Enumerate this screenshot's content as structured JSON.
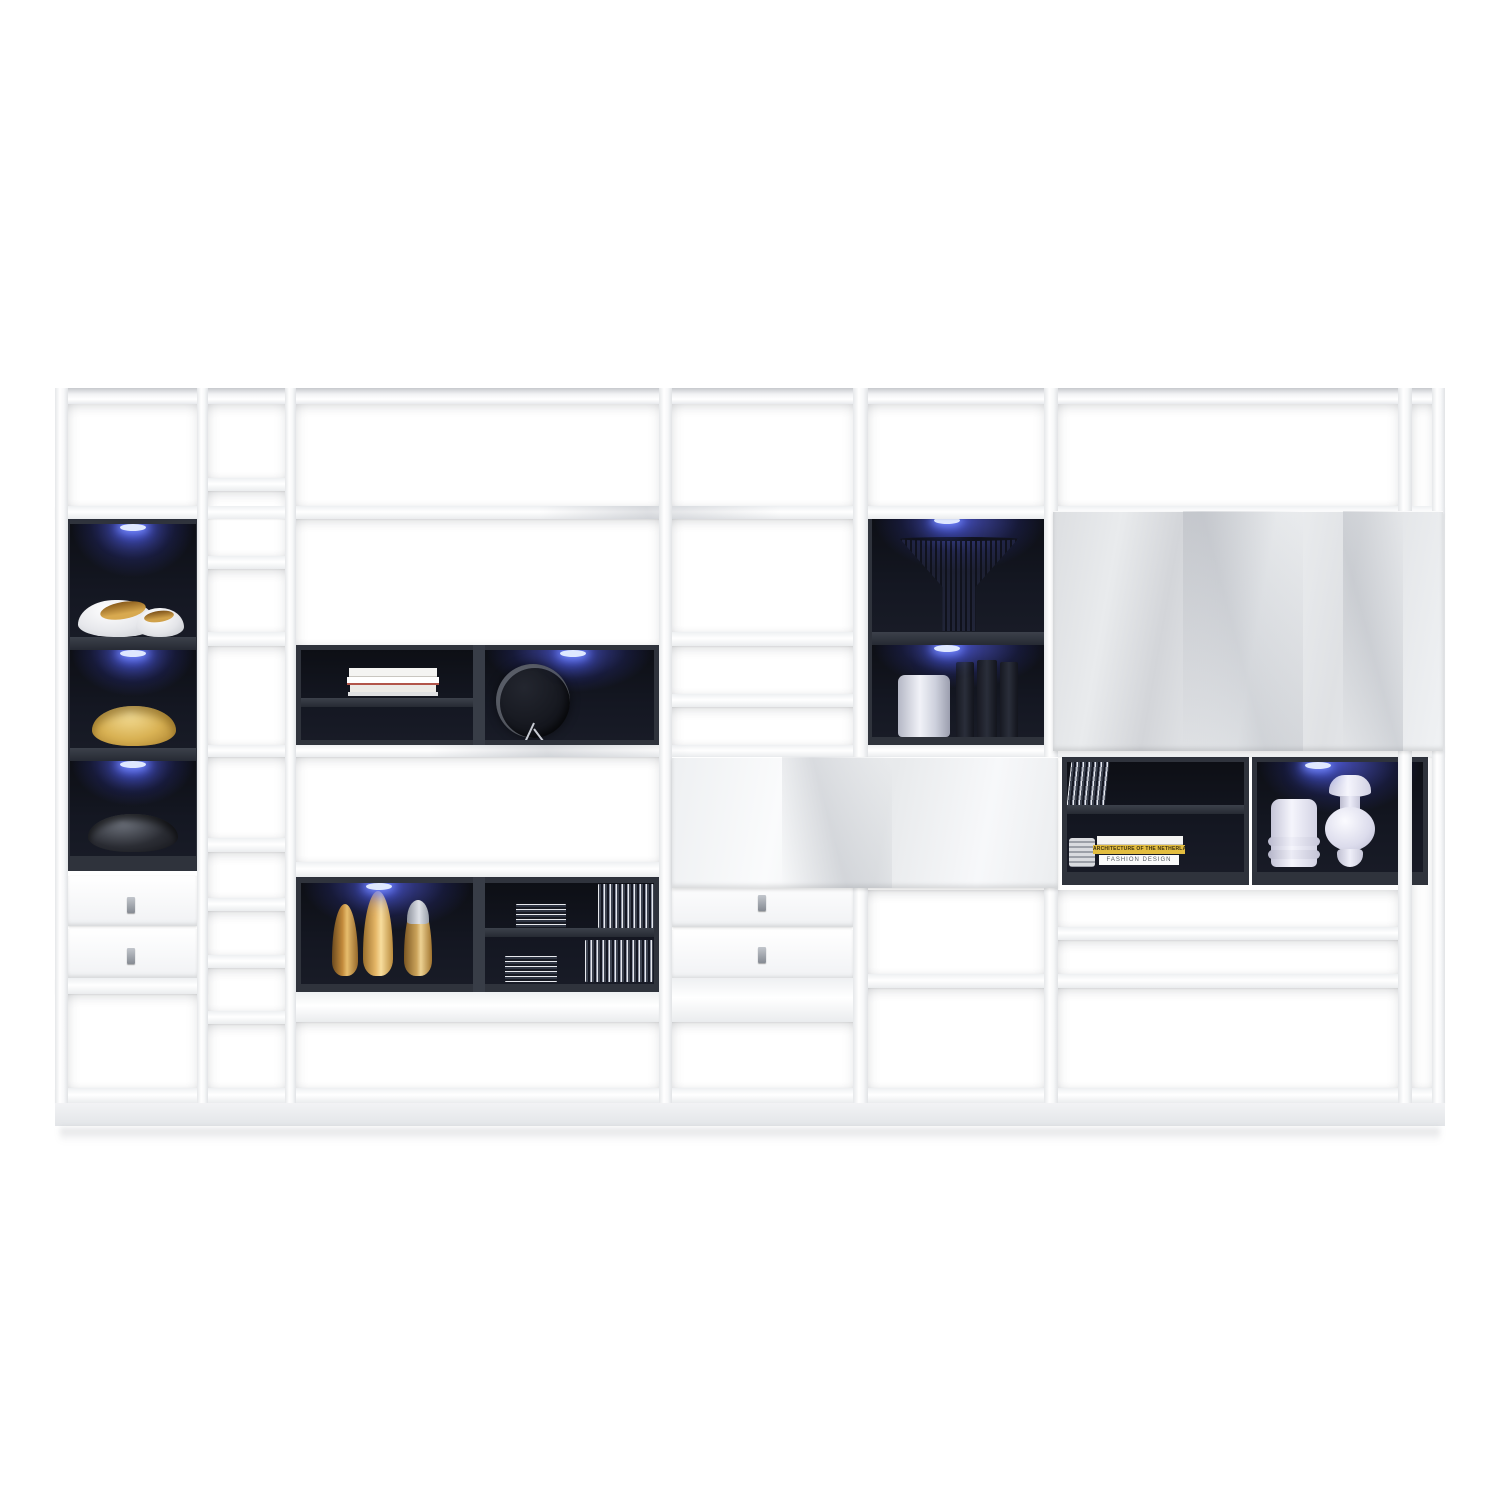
{
  "scene": {
    "type": "furniture product photo",
    "subject": "modular white high-gloss living-room wall shelving unit",
    "lighting": "blue LED spotlights inside dark display compartments",
    "background": "plain white studio background"
  },
  "palette": {
    "background": "#ffffff",
    "frame_white": "#f4f5f7",
    "frame_shadow": "#dadce0",
    "compartment_dark": "#12141c",
    "compartment_frame": "#2f333c",
    "led_blue": "#5a6cf0",
    "glass_panel_gray": "#e3e5e8",
    "gold": "#d9a85a",
    "silver": "#c9ccd4",
    "book_yellow": "#e3bd3f"
  },
  "texts": {
    "book_spine_yellow": "ARCHITECTURE OF THE NETHERLANDS",
    "book_spine_white": "FASHION DESIGN"
  },
  "objects": {
    "bowl_duo": "two white decorative shell bowls with gold interiors",
    "gold_bowl": "gold wavy decorative bowl",
    "black_bowl": "dark metallic decorative bowl",
    "wire_basket": "black wire cone basket",
    "white_cylinder_vase": "ribbed silver-white vase",
    "dark_books": "row of dark books",
    "book_stack": "stack of architecture books",
    "wall_clock": "round dark wall clock",
    "gold_vases": "three gold bottle-shaped vases",
    "cd_stack": "stack of CDs",
    "zigzag_sculpture": "small pleated paper sculpture",
    "design_books": "pile of design books",
    "white_vases": "two white ceramic vases"
  }
}
